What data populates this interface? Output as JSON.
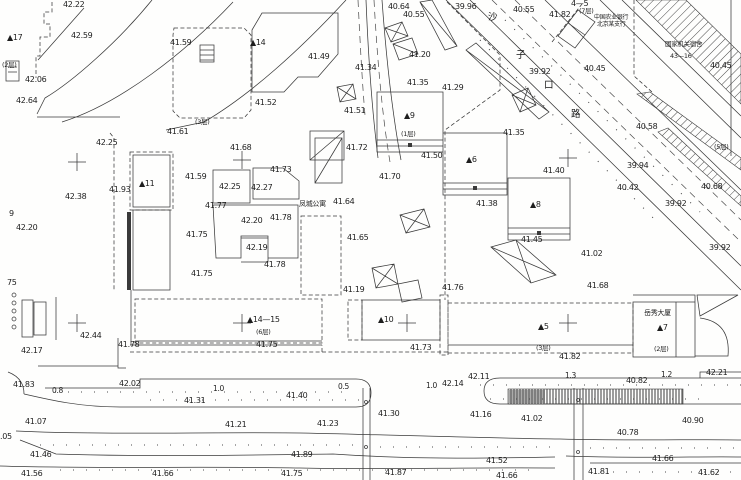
{
  "drawing": {
    "background": "#fefefd",
    "ink": "#3a3a3a",
    "label_color": "#1e1e1e"
  },
  "texts": {
    "bank_line1": "中国农业银行",
    "bank_line2": "北京某支行",
    "gov_line1": "国家机关宿舍",
    "gov_line2": "43—16",
    "apartment": "凤城公寓",
    "mansion": "岳秀大厦"
  },
  "street_name": {
    "label": "沙子口路",
    "chars": [
      {
        "c": "沙",
        "x": 488,
        "y": 13
      },
      {
        "c": "子",
        "x": 516,
        "y": 51
      },
      {
        "c": "口",
        "x": 544,
        "y": 81
      },
      {
        "c": "路",
        "x": 571,
        "y": 110
      }
    ]
  },
  "labels": {
    "elevations": [
      {
        "t": "42.22",
        "x": 63,
        "y": 1
      },
      {
        "t": "42.59",
        "x": 71,
        "y": 32
      },
      {
        "t": "41.59",
        "x": 170,
        "y": 39
      },
      {
        "t": "42.06",
        "x": 25,
        "y": 76
      },
      {
        "t": "42.64",
        "x": 16,
        "y": 97
      },
      {
        "t": "41.61",
        "x": 167,
        "y": 128
      },
      {
        "t": "42.25",
        "x": 96,
        "y": 139
      },
      {
        "t": "41.49",
        "x": 308,
        "y": 53
      },
      {
        "t": "41.52",
        "x": 255,
        "y": 99
      },
      {
        "t": "41.51",
        "x": 344,
        "y": 107
      },
      {
        "t": "41.34",
        "x": 355,
        "y": 64
      },
      {
        "t": "40.64",
        "x": 388,
        "y": 3
      },
      {
        "t": "40.55",
        "x": 403,
        "y": 11
      },
      {
        "t": "39.96",
        "x": 455,
        "y": 3
      },
      {
        "t": "40.55",
        "x": 513,
        "y": 6
      },
      {
        "t": "41.82",
        "x": 549,
        "y": 11
      },
      {
        "t": "39.92",
        "x": 529,
        "y": 68
      },
      {
        "t": "40.45",
        "x": 584,
        "y": 65
      },
      {
        "t": "40.45",
        "x": 710,
        "y": 62
      },
      {
        "t": "40.58",
        "x": 636,
        "y": 123
      },
      {
        "t": "39.94",
        "x": 627,
        "y": 162
      },
      {
        "t": "40.42",
        "x": 617,
        "y": 184
      },
      {
        "t": "40.68",
        "x": 701,
        "y": 183
      },
      {
        "t": "39.92",
        "x": 665,
        "y": 200
      },
      {
        "t": "39.92",
        "x": 709,
        "y": 244
      },
      {
        "t": "41.29",
        "x": 442,
        "y": 84
      },
      {
        "t": "41.35",
        "x": 407,
        "y": 79
      },
      {
        "t": "41.20",
        "x": 409,
        "y": 51
      },
      {
        "t": "41.35",
        "x": 503,
        "y": 129
      },
      {
        "t": "41.40",
        "x": 543,
        "y": 167
      },
      {
        "t": "41.45",
        "x": 521,
        "y": 236
      },
      {
        "t": "41.38",
        "x": 476,
        "y": 200
      },
      {
        "t": "41.02",
        "x": 581,
        "y": 250
      },
      {
        "t": "41.68",
        "x": 587,
        "y": 282
      },
      {
        "t": "41.50",
        "x": 421,
        "y": 152
      },
      {
        "t": "41.70",
        "x": 379,
        "y": 173
      },
      {
        "t": "41.72",
        "x": 346,
        "y": 144
      },
      {
        "t": "41.64",
        "x": 333,
        "y": 198
      },
      {
        "t": "41.65",
        "x": 347,
        "y": 234
      },
      {
        "t": "41.93",
        "x": 109,
        "y": 186
      },
      {
        "t": "42.38",
        "x": 65,
        "y": 193
      },
      {
        "t": "42.20",
        "x": 16,
        "y": 224
      },
      {
        "t": "41.68",
        "x": 230,
        "y": 144
      },
      {
        "t": "41.59",
        "x": 185,
        "y": 173
      },
      {
        "t": "42.25",
        "x": 219,
        "y": 183
      },
      {
        "t": "42.27",
        "x": 251,
        "y": 184
      },
      {
        "t": "41.73",
        "x": 270,
        "y": 166
      },
      {
        "t": "41.77",
        "x": 205,
        "y": 202
      },
      {
        "t": "42.20",
        "x": 241,
        "y": 217
      },
      {
        "t": "41.78",
        "x": 270,
        "y": 214
      },
      {
        "t": "41.75",
        "x": 186,
        "y": 231
      },
      {
        "t": "42.19",
        "x": 246,
        "y": 244
      },
      {
        "t": "41.78",
        "x": 264,
        "y": 261
      },
      {
        "t": "41.75",
        "x": 191,
        "y": 270
      },
      {
        "t": "42.44",
        "x": 80,
        "y": 332
      },
      {
        "t": "42.17",
        "x": 21,
        "y": 347
      },
      {
        "t": "41.78",
        "x": 118,
        "y": 341
      },
      {
        "t": "41.83",
        "x": 13,
        "y": 381
      },
      {
        "t": "42.02",
        "x": 119,
        "y": 380
      },
      {
        "t": "41.31",
        "x": 184,
        "y": 397
      },
      {
        "t": "41.07",
        "x": 25,
        "y": 418
      },
      {
        "t": ".05",
        "x": 0,
        "y": 433
      },
      {
        "t": "41.46",
        "x": 30,
        "y": 451
      },
      {
        "t": "41.21",
        "x": 225,
        "y": 421
      },
      {
        "t": "41.23",
        "x": 317,
        "y": 420
      },
      {
        "t": "41.40",
        "x": 286,
        "y": 392
      },
      {
        "t": "42.14",
        "x": 442,
        "y": 380
      },
      {
        "t": "42.11",
        "x": 468,
        "y": 373
      },
      {
        "t": "41.30",
        "x": 378,
        "y": 410
      },
      {
        "t": "41.16",
        "x": 470,
        "y": 411
      },
      {
        "t": "41.89",
        "x": 291,
        "y": 451
      },
      {
        "t": "41.19",
        "x": 343,
        "y": 286
      },
      {
        "t": "41.76",
        "x": 442,
        "y": 284
      },
      {
        "t": "41.75",
        "x": 256,
        "y": 341
      },
      {
        "t": "41.73",
        "x": 410,
        "y": 344
      },
      {
        "t": "41.82",
        "x": 559,
        "y": 353
      },
      {
        "t": "42.21",
        "x": 706,
        "y": 369
      },
      {
        "t": "40.82",
        "x": 626,
        "y": 377
      },
      {
        "t": "41.02",
        "x": 521,
        "y": 415
      },
      {
        "t": "40.90",
        "x": 682,
        "y": 417
      },
      {
        "t": "40.78",
        "x": 617,
        "y": 429
      },
      {
        "t": "41.66",
        "x": 652,
        "y": 455
      },
      {
        "t": "41.52",
        "x": 486,
        "y": 457
      },
      {
        "t": "41.56",
        "x": 21,
        "y": 470
      },
      {
        "t": "41.66",
        "x": 152,
        "y": 470
      },
      {
        "t": "41.75",
        "x": 281,
        "y": 470
      },
      {
        "t": "41.87",
        "x": 385,
        "y": 469
      },
      {
        "t": "41.66",
        "x": 496,
        "y": 472
      },
      {
        "t": "41.81",
        "x": 588,
        "y": 468
      },
      {
        "t": "41.62",
        "x": 698,
        "y": 469
      },
      {
        "t": "9",
        "x": 9,
        "y": 210
      },
      {
        "t": "75",
        "x": 7,
        "y": 279
      }
    ],
    "buildings": [
      {
        "t": "▲17",
        "x": 7,
        "y": 34
      },
      {
        "t": "▲14",
        "x": 250,
        "y": 39
      },
      {
        "t": "▲11",
        "x": 139,
        "y": 180
      },
      {
        "t": "▲9",
        "x": 404,
        "y": 112
      },
      {
        "t": "▲6",
        "x": 466,
        "y": 156
      },
      {
        "t": "▲8",
        "x": 530,
        "y": 201
      },
      {
        "t": "▲14—15",
        "x": 247,
        "y": 316
      },
      {
        "t": "▲10",
        "x": 378,
        "y": 316
      },
      {
        "t": "▲5",
        "x": 538,
        "y": 323
      },
      {
        "t": "▲7",
        "x": 657,
        "y": 324
      },
      {
        "t": "4—5",
        "x": 571,
        "y": 0
      }
    ],
    "floors": [
      {
        "t": "(2层)",
        "x": 2,
        "y": 62
      },
      {
        "t": "(3层)",
        "x": 195,
        "y": 119
      },
      {
        "t": "(7层)",
        "x": 579,
        "y": 8
      },
      {
        "t": "(1层)",
        "x": 401,
        "y": 131
      },
      {
        "t": "(6层)",
        "x": 256,
        "y": 329
      },
      {
        "t": "(3层)",
        "x": 536,
        "y": 345
      },
      {
        "t": "(2层)",
        "x": 654,
        "y": 346
      },
      {
        "t": "(5层)",
        "x": 714,
        "y": 144
      }
    ],
    "widths": [
      {
        "t": "0.8",
        "x": 52,
        "y": 387
      },
      {
        "t": "1.0",
        "x": 213,
        "y": 385
      },
      {
        "t": "0.5",
        "x": 338,
        "y": 383
      },
      {
        "t": "1.0",
        "x": 426,
        "y": 382
      },
      {
        "t": "1.3",
        "x": 565,
        "y": 372
      },
      {
        "t": "1.2",
        "x": 661,
        "y": 371
      }
    ]
  },
  "crosses": [
    [
      77,
      162
    ],
    [
      242,
      160
    ],
    [
      568,
      158
    ],
    [
      77,
      323
    ],
    [
      242,
      323
    ],
    [
      407,
      323
    ],
    [
      568,
      323
    ]
  ]
}
